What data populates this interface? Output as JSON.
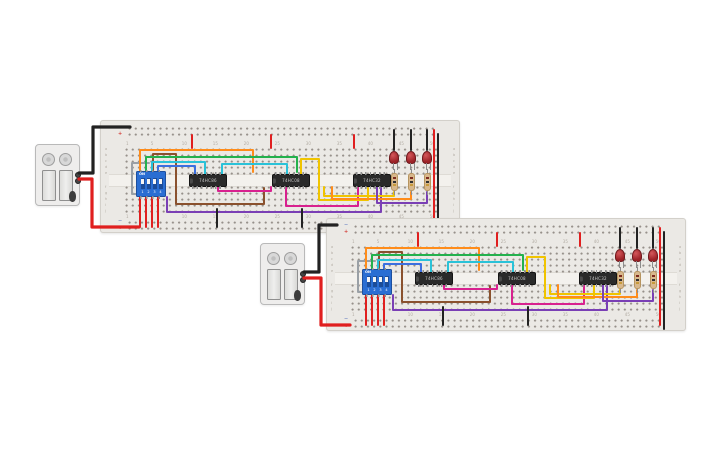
{
  "canvas": {
    "width": 725,
    "height": 453,
    "background": "#ffffff"
  },
  "board_template": {
    "width": 360,
    "height": 113,
    "rail_plus": "+",
    "rail_minus": "−",
    "column_labels": [
      "1",
      "5",
      "10",
      "15",
      "20",
      "25",
      "30",
      "35",
      "40",
      "45",
      "50"
    ],
    "row_letters_top": [
      "a",
      "b",
      "c",
      "d",
      "e"
    ],
    "row_letters_bottom": [
      "f",
      "g",
      "h",
      "i",
      "j"
    ],
    "dip": {
      "x": 35,
      "y": 50,
      "on_label": "ON",
      "pin_labels": [
        "1",
        "2",
        "3",
        "4"
      ]
    },
    "ic_positions": [
      {
        "x": 88,
        "y": 53
      },
      {
        "x": 171,
        "y": 53
      },
      {
        "x": 252,
        "y": 53
      }
    ],
    "led_xs": [
      293,
      310,
      326
    ],
    "led_y": 30,
    "resistor_xs": [
      293,
      310,
      326
    ],
    "resistor_y": 52,
    "wires": [
      {
        "name": "wire-gray-dip-loop",
        "color": "#9aa0a6",
        "pts": [
          [
            48,
            42
          ],
          [
            31,
            42
          ],
          [
            31,
            73
          ],
          [
            40,
            73
          ]
        ]
      },
      {
        "name": "wire-orange-row",
        "color": "#ff8c1a",
        "pts": [
          [
            39,
            50
          ],
          [
            39,
            29
          ],
          [
            152,
            29
          ],
          [
            152,
            51
          ]
        ]
      },
      {
        "name": "wire-brown-row",
        "color": "#8a512e",
        "pts": [
          [
            52,
            50
          ],
          [
            52,
            33
          ],
          [
            75,
            33
          ],
          [
            75,
            83
          ],
          [
            163,
            83
          ],
          [
            163,
            67
          ]
        ]
      },
      {
        "name": "wire-green-row",
        "color": "#23b14d",
        "pts": [
          [
            45,
            50
          ],
          [
            45,
            36
          ],
          [
            196,
            36
          ],
          [
            196,
            51
          ]
        ]
      },
      {
        "name": "wire-cyan-1",
        "color": "#2ac2d8",
        "pts": [
          [
            51,
            50
          ],
          [
            51,
            41
          ],
          [
            104,
            41
          ],
          [
            104,
            53
          ]
        ]
      },
      {
        "name": "wire-cyan-2",
        "color": "#2ac2d8",
        "pts": [
          [
            121,
            53
          ],
          [
            121,
            43
          ],
          [
            186,
            43
          ],
          [
            186,
            53
          ]
        ]
      },
      {
        "name": "wire-blue",
        "color": "#3b6fe0",
        "pts": [
          [
            57,
            50
          ],
          [
            57,
            45
          ],
          [
            94,
            45
          ],
          [
            94,
            53
          ]
        ]
      },
      {
        "name": "wire-magenta-1",
        "color": "#d8218f",
        "pts": [
          [
            117,
            66
          ],
          [
            117,
            70
          ],
          [
            170,
            70
          ],
          [
            170,
            66
          ]
        ]
      },
      {
        "name": "wire-magenta-2",
        "color": "#d8218f",
        "pts": [
          [
            185,
            66
          ],
          [
            185,
            85
          ],
          [
            257,
            85
          ],
          [
            257,
            66
          ]
        ]
      },
      {
        "name": "wire-purple-long",
        "color": "#7a3fb5",
        "pts": [
          [
            66,
            76
          ],
          [
            66,
            91
          ],
          [
            280,
            91
          ],
          [
            280,
            67
          ]
        ]
      },
      {
        "name": "wire-yellow-loop",
        "color": "#f0c400",
        "pts": [
          [
            200,
            53
          ],
          [
            200,
            38
          ],
          [
            218,
            38
          ],
          [
            218,
            79
          ],
          [
            267,
            79
          ],
          [
            267,
            67
          ]
        ]
      },
      {
        "name": "wire-yellow-out",
        "color": "#f0c400",
        "pts": [
          [
            223,
            66
          ],
          [
            223,
            75
          ],
          [
            293,
            75
          ],
          [
            293,
            71
          ]
        ]
      },
      {
        "name": "wire-orange-out",
        "color": "#ff8c1a",
        "pts": [
          [
            231,
            66
          ],
          [
            231,
            78
          ],
          [
            310,
            78
          ],
          [
            310,
            71
          ]
        ]
      },
      {
        "name": "wire-purple-out",
        "color": "#7a3fb5",
        "pts": [
          [
            276,
            66
          ],
          [
            276,
            82
          ],
          [
            326,
            82
          ],
          [
            326,
            71
          ]
        ]
      },
      {
        "name": "wire-black-led-1",
        "color": "#222222",
        "pts": [
          [
            293,
            9
          ],
          [
            293,
            29
          ]
        ]
      },
      {
        "name": "wire-black-led-2",
        "color": "#222222",
        "pts": [
          [
            310,
            9
          ],
          [
            310,
            29
          ]
        ]
      },
      {
        "name": "wire-black-led-3",
        "color": "#222222",
        "pts": [
          [
            326,
            9
          ],
          [
            326,
            29
          ]
        ]
      },
      {
        "name": "wire-red-power-1",
        "color": "#e01f1f",
        "pts": [
          [
            91,
            14
          ],
          [
            91,
            27
          ]
        ]
      },
      {
        "name": "wire-red-power-2",
        "color": "#e01f1f",
        "pts": [
          [
            170,
            14
          ],
          [
            170,
            27
          ]
        ]
      },
      {
        "name": "wire-red-power-3",
        "color": "#e01f1f",
        "pts": [
          [
            253,
            14
          ],
          [
            253,
            27
          ]
        ]
      },
      {
        "name": "wire-black-gnd-1",
        "color": "#222222",
        "pts": [
          [
            116,
            88
          ],
          [
            116,
            106
          ]
        ]
      },
      {
        "name": "wire-black-gnd-2",
        "color": "#222222",
        "pts": [
          [
            201,
            88
          ],
          [
            201,
            106
          ]
        ]
      },
      {
        "name": "wire-red-dip-1",
        "color": "#e01f1f",
        "pts": [
          [
            39,
            76
          ],
          [
            39,
            106
          ]
        ]
      },
      {
        "name": "wire-red-dip-2",
        "color": "#e01f1f",
        "pts": [
          [
            45,
            76
          ],
          [
            45,
            106
          ]
        ]
      },
      {
        "name": "wire-red-dip-3",
        "color": "#e01f1f",
        "pts": [
          [
            51,
            76
          ],
          [
            51,
            106
          ]
        ]
      },
      {
        "name": "wire-red-dip-4",
        "color": "#e01f1f",
        "pts": [
          [
            57,
            76
          ],
          [
            57,
            106
          ]
        ]
      },
      {
        "name": "wire-red-rail-link",
        "color": "#e01f1f",
        "pts": [
          [
            333,
            9
          ],
          [
            333,
            106
          ]
        ]
      },
      {
        "name": "wire-black-rail-link",
        "color": "#222222",
        "pts": [
          [
            337,
            13
          ],
          [
            337,
            110
          ]
        ]
      }
    ]
  },
  "boards": [
    {
      "name": "breadboard-1",
      "x": 100,
      "y": 120,
      "ic_labels": [
        "74HC86",
        "74HC08",
        "74HC32"
      ]
    },
    {
      "name": "breadboard-2",
      "x": 326,
      "y": 218,
      "ic_labels": [
        "74HC86",
        "74HC08",
        "74HC32"
      ]
    }
  ],
  "batteries": [
    {
      "name": "battery-pack-1",
      "x": 35,
      "y": 144
    },
    {
      "name": "battery-pack-2",
      "x": 260,
      "y": 243
    }
  ],
  "global_wires": [
    {
      "name": "battery1-negative-lead",
      "color": "#222222",
      "w": 3.2,
      "pts": [
        [
          79,
          173
        ],
        [
          93,
          173
        ],
        [
          93,
          127
        ],
        [
          130,
          127
        ]
      ]
    },
    {
      "name": "battery1-positive-lead",
      "color": "#e01f1f",
      "w": 3.2,
      "pts": [
        [
          79,
          179
        ],
        [
          92,
          179
        ],
        [
          92,
          227
        ],
        [
          139,
          227
        ]
      ]
    },
    {
      "name": "battery2-negative-lead",
      "color": "#222222",
      "w": 3.2,
      "pts": [
        [
          304,
          272
        ],
        [
          319,
          272
        ],
        [
          319,
          225
        ],
        [
          337,
          225
        ]
      ]
    },
    {
      "name": "battery2-positive-lead",
      "color": "#e01f1f",
      "w": 3.2,
      "pts": [
        [
          304,
          278
        ],
        [
          321,
          278
        ],
        [
          321,
          325
        ],
        [
          350,
          325
        ]
      ]
    }
  ],
  "colors": {
    "board": "#ebe9e5",
    "wire_red": "#e01f1f",
    "wire_black": "#222222",
    "dip_blue": "#2a6ed3",
    "led_red": "#9c2227"
  }
}
